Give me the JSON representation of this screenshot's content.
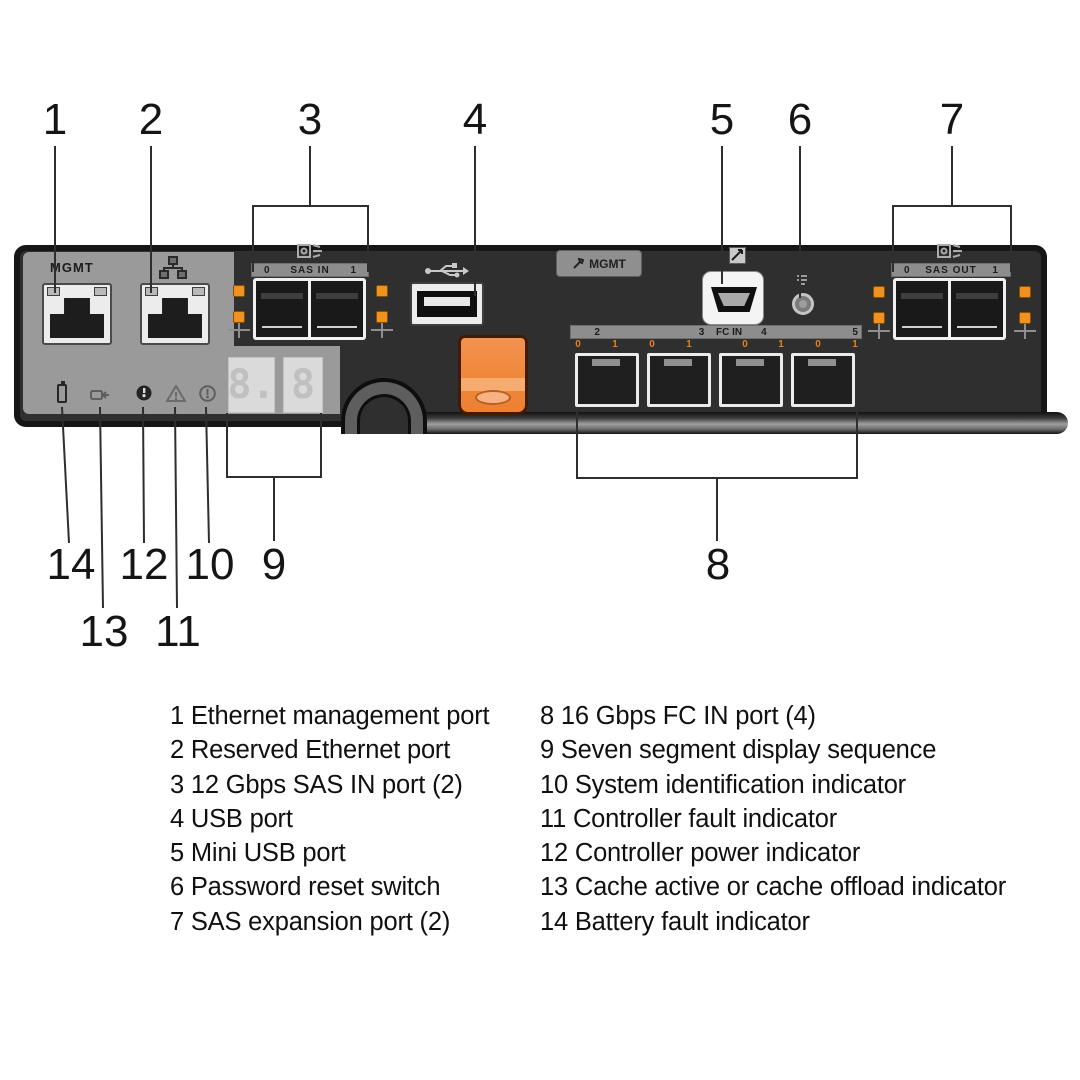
{
  "callouts": {
    "c1": "1",
    "c2": "2",
    "c3": "3",
    "c4": "4",
    "c5": "5",
    "c6": "6",
    "c7": "7",
    "c8": "8",
    "c9": "9",
    "c10": "10",
    "c11": "11",
    "c12": "12",
    "c13": "13",
    "c14": "14"
  },
  "panel": {
    "mgmt_port_label": "MGMT",
    "sas_in": {
      "num_left": "0",
      "label": "SAS IN",
      "num_right": "1"
    },
    "mgmt_badge": "MGMT",
    "sas_out": {
      "num_left": "0",
      "label": "SAS OUT",
      "num_right": "1"
    },
    "fc_in": {
      "s2": "2",
      "s3": "3",
      "label": "FC IN",
      "s4": "4",
      "s5": "5",
      "leds": [
        "0",
        "1",
        "0",
        "1",
        "0",
        "1",
        "0",
        "1"
      ]
    },
    "seven_segment": {
      "d1": "8.",
      "d2": "8"
    }
  },
  "legend": {
    "left": [
      "1 Ethernet management port",
      "2 Reserved Ethernet port",
      "3 12 Gbps SAS IN port (2)",
      "4 USB port",
      "5 Mini USB port",
      "6 Password reset switch",
      "7 SAS expansion port (2)"
    ],
    "right": [
      "8 16 Gbps FC IN port (4)",
      "9 Seven segment display sequence",
      "10 System identification indicator",
      "11 Controller fault indicator",
      "12 Controller power indicator",
      "13 Cache active or cache offload indicator",
      "14 Battery fault indicator"
    ]
  },
  "colors": {
    "panel_dark": "#2F2F2F",
    "panel_gray": "#9A9A9A",
    "led_orange": "#F0921E",
    "latch_orange": "#EF8738",
    "callout_text": "#151515"
  }
}
